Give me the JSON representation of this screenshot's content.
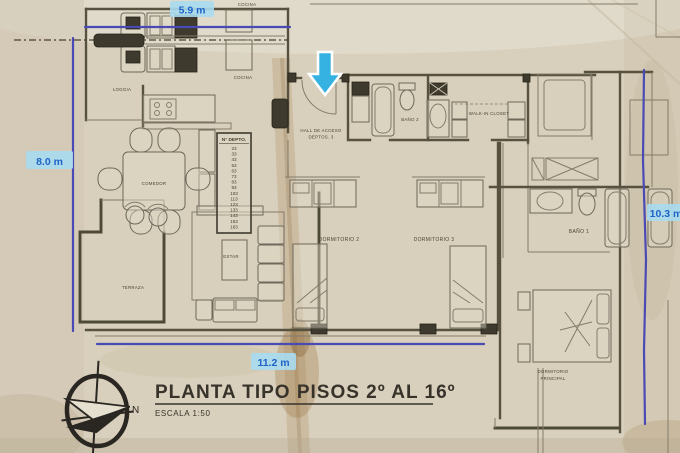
{
  "title": {
    "main": "PLANTA TIPO PISOS 2º AL 16º",
    "scale": "ESCALA 1:50"
  },
  "compass": {
    "north_label": "N"
  },
  "dimensions": {
    "top": "5.9 m",
    "left": "8.0 m",
    "bottom": "11.2 m",
    "right": "10.3 m"
  },
  "rooms": {
    "cocina_upper": "COCINA",
    "cocina": "COCINA",
    "loggia": "LOGGIA",
    "comedor": "COMEDOR",
    "estar": "ESTAR",
    "terraza": "TERRAZA",
    "hall_line1": "HALL DE ACCESO",
    "hall_line2": "DEPTOS. 3",
    "bano2": "BAÑO 2",
    "walk_in_closet": "WALK-IN CLOSET",
    "dormitorio2": "DORMITORIO 2",
    "dormitorio3": "DORMITORIO 3",
    "bano1": "BAÑO 1",
    "dorm_principal_line1": "DORMITORIO",
    "dorm_principal_line2": "PRINCIPAL"
  },
  "depto_table": {
    "header": "N° DEPTO.",
    "numbers": [
      "23",
      "33",
      "43",
      "53",
      "63",
      "73",
      "83",
      "93",
      "103",
      "113",
      "123",
      "133",
      "143",
      "153",
      "163"
    ]
  },
  "colors": {
    "paper": "#d8cfbc",
    "dimension_line": "#4a4ab5",
    "dim_text": "#1e63c8",
    "dim_highlight": "#a9dbf0",
    "arrow": "#35b2e2",
    "ink": "#57513f"
  }
}
